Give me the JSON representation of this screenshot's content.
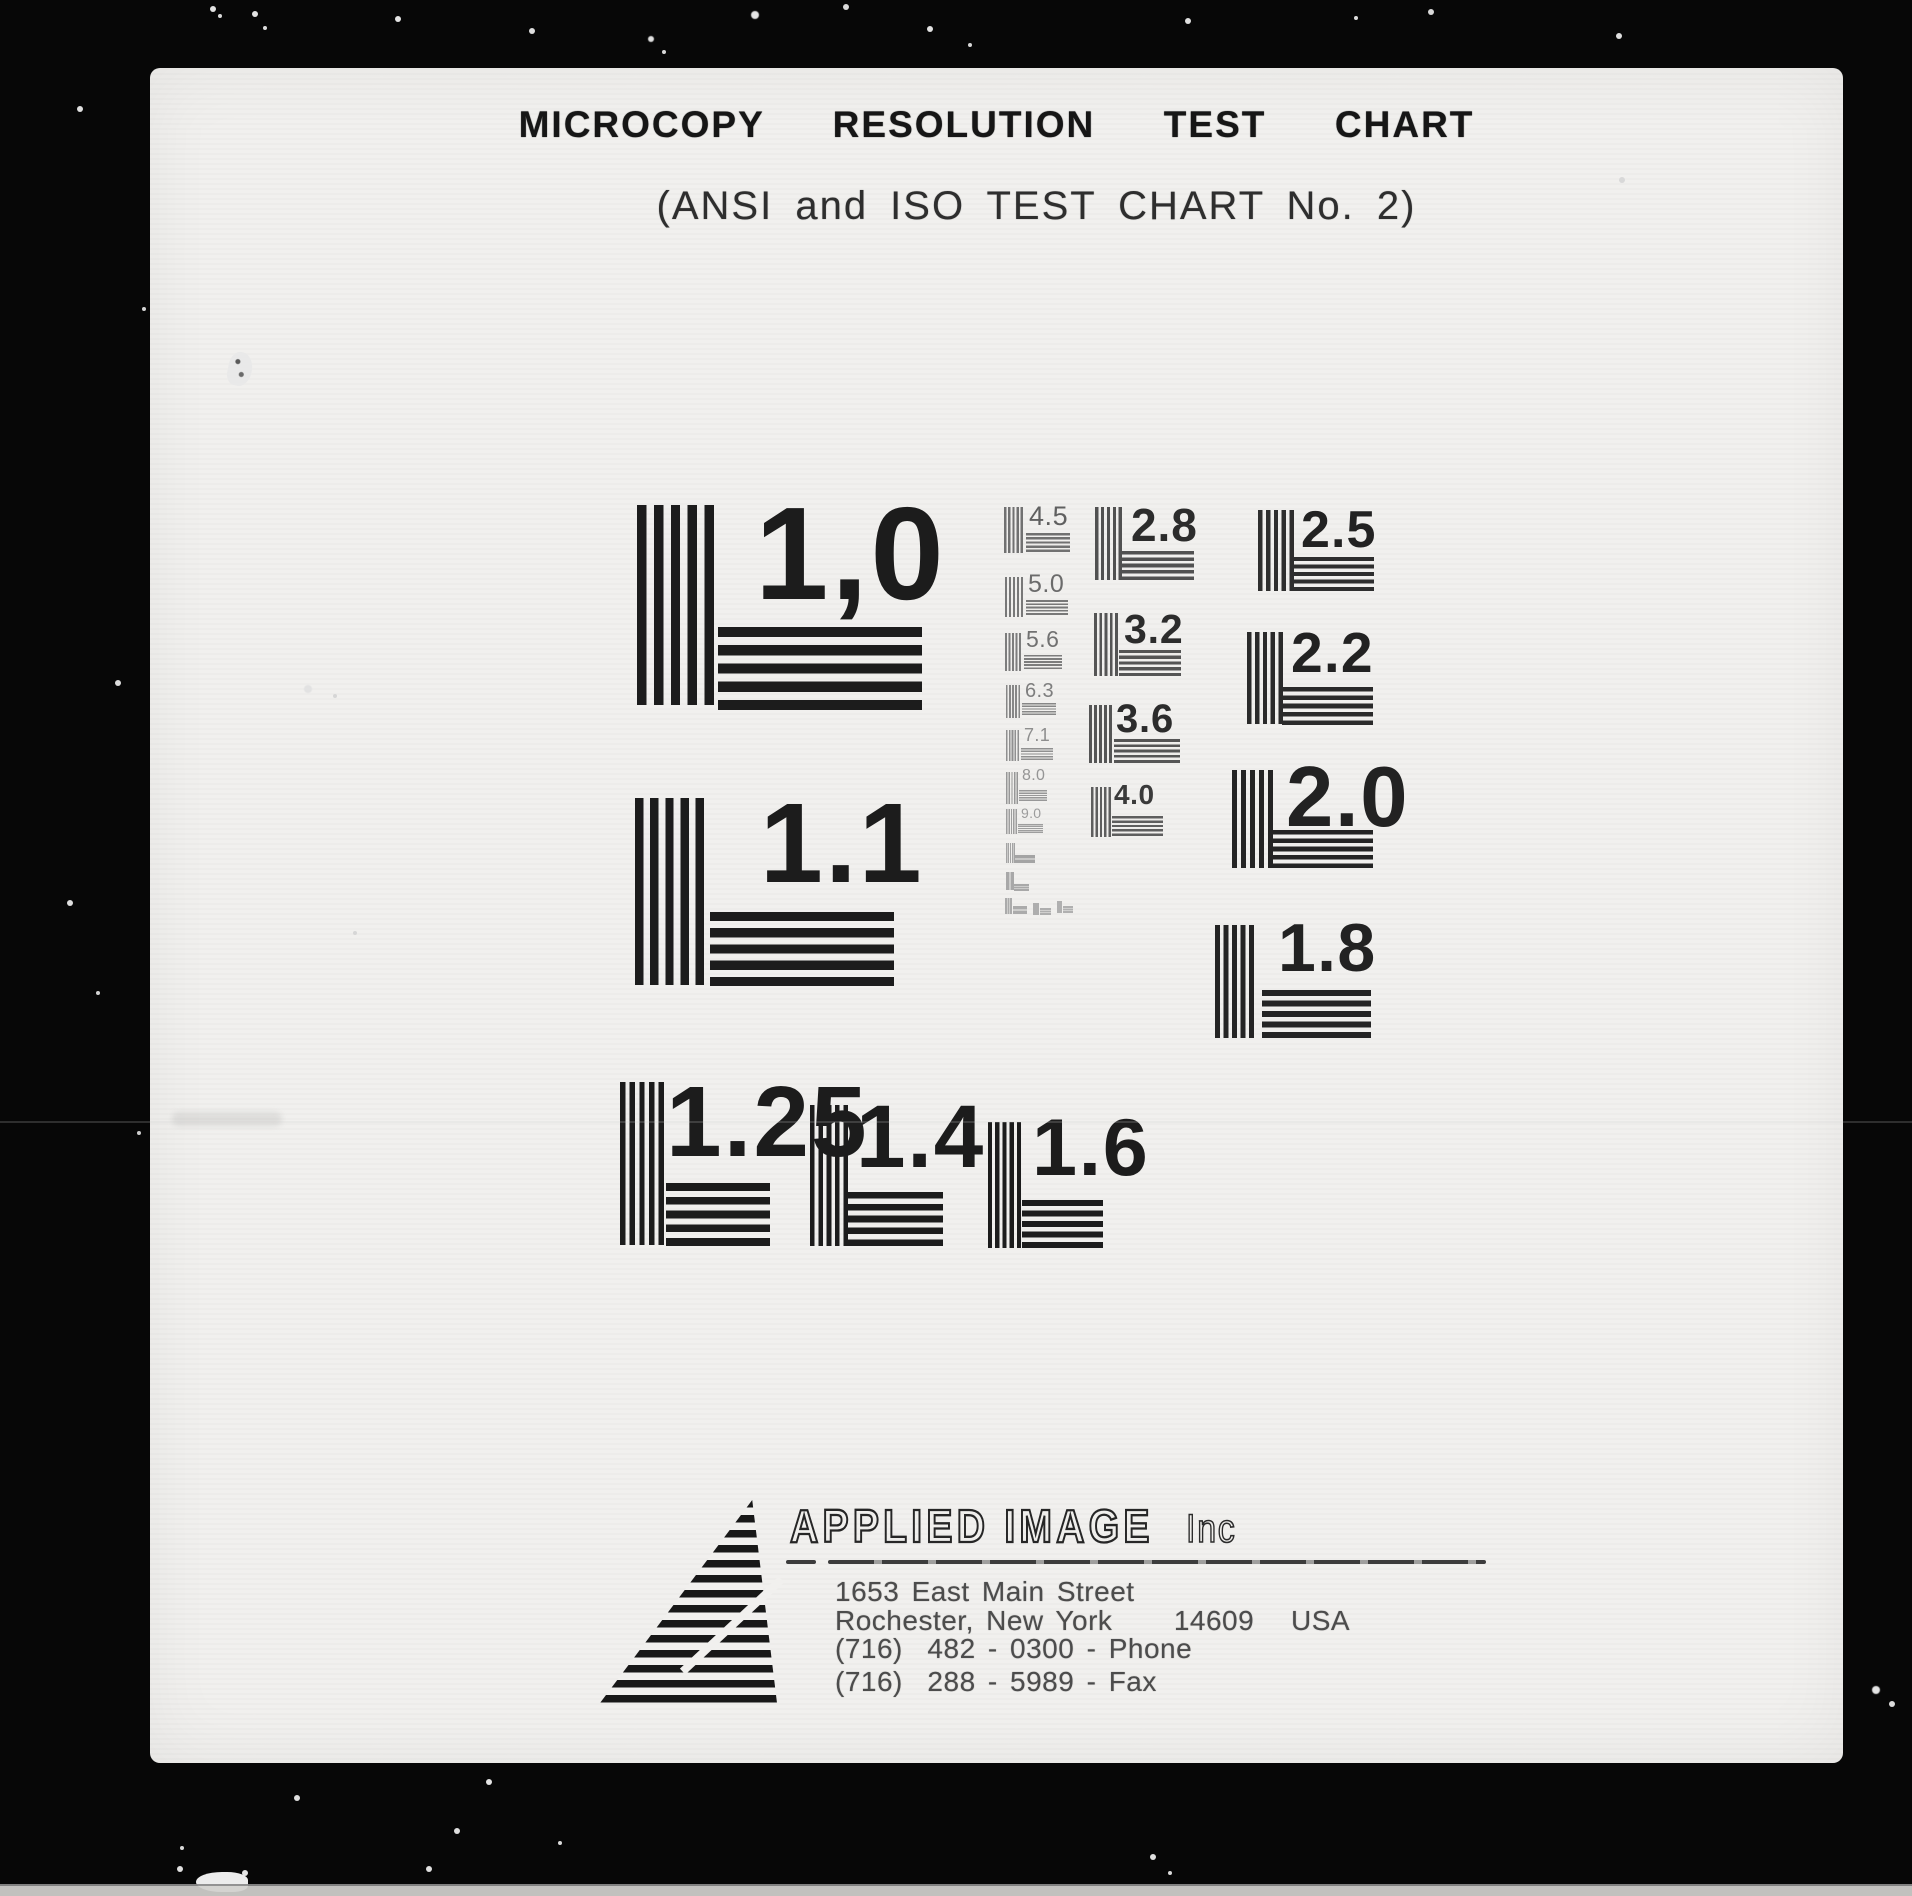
{
  "document": {
    "title": "MICROCOPY  RESOLUTION  TEST  CHART",
    "subtitle": "(ANSI and ISO TEST CHART No. 2)"
  },
  "patterns": [
    {
      "label": "1,0",
      "ink": "#1c1c1c",
      "bar": "#1c1c1c",
      "v": [
        637,
        505,
        77,
        200
      ],
      "h": [
        718,
        627,
        204,
        83
      ],
      "n": [
        755,
        488,
        132,
        700
      ]
    },
    {
      "label": "1.1",
      "ink": "#1c1c1c",
      "bar": "#1c1c1c",
      "v": [
        635,
        798,
        69,
        187
      ],
      "h": [
        710,
        912,
        184,
        74
      ],
      "n": [
        760,
        787,
        113,
        700
      ]
    },
    {
      "label": "1.25",
      "ink": "#1c1c1c",
      "bar": "#1c1c1c",
      "v": [
        620,
        1082,
        44,
        163
      ],
      "h": [
        666,
        1183,
        104,
        63
      ],
      "n": [
        666,
        1072,
        100,
        700
      ]
    },
    {
      "label": "1.4",
      "ink": "#1c1c1c",
      "bar": "#1c1c1c",
      "v": [
        810,
        1105,
        38,
        141
      ],
      "h": [
        848,
        1192,
        95,
        54
      ],
      "n": [
        856,
        1092,
        89,
        700
      ]
    },
    {
      "label": "1.6",
      "ink": "#1c1c1c",
      "bar": "#1c1c1c",
      "v": [
        988,
        1122,
        33,
        126
      ],
      "h": [
        1022,
        1200,
        81,
        48
      ],
      "n": [
        1032,
        1108,
        81,
        700
      ]
    },
    {
      "label": "1.8",
      "ink": "#222222",
      "bar": "#242424",
      "v": [
        1215,
        925,
        39,
        113
      ],
      "h": [
        1262,
        990,
        109,
        48
      ],
      "n": [
        1278,
        914,
        68,
        700
      ]
    },
    {
      "label": "2.0",
      "ink": "#222222",
      "bar": "#242424",
      "v": [
        1232,
        770,
        41,
        98
      ],
      "h": [
        1273,
        830,
        100,
        38
      ],
      "n": [
        1286,
        755,
        85,
        700
      ]
    },
    {
      "label": "2.2",
      "ink": "#222222",
      "bar": "#2a2a2a",
      "v": [
        1247,
        632,
        36,
        92
      ],
      "h": [
        1282,
        687,
        91,
        38
      ],
      "n": [
        1291,
        625,
        57,
        700
      ]
    },
    {
      "label": "2.5",
      "ink": "#222222",
      "bar": "#2e2e2e",
      "v": [
        1258,
        510,
        36,
        81
      ],
      "h": [
        1294,
        557,
        80,
        34
      ],
      "n": [
        1301,
        504,
        52,
        700
      ]
    },
    {
      "label": "2.8",
      "ink": "#2c2c2c",
      "bar": "#515151",
      "v": [
        1095,
        507,
        27,
        73
      ],
      "h": [
        1122,
        551,
        72,
        29
      ],
      "n": [
        1131,
        502,
        46,
        700
      ]
    },
    {
      "label": "3.2",
      "ink": "#2c2c2c",
      "bar": "#555555",
      "v": [
        1094,
        613,
        24,
        63
      ],
      "h": [
        1119,
        650,
        62,
        26
      ],
      "n": [
        1124,
        609,
        41,
        700
      ]
    },
    {
      "label": "3.6",
      "ink": "#2c2c2c",
      "bar": "#555555",
      "v": [
        1089,
        705,
        23,
        58
      ],
      "h": [
        1114,
        739,
        66,
        24
      ],
      "n": [
        1116,
        699,
        40,
        700
      ]
    },
    {
      "label": "4.0",
      "ink": "#3a3a3a",
      "bar": "#5e5e5e",
      "v": [
        1091,
        787,
        20,
        50
      ],
      "h": [
        1112,
        816,
        51,
        20
      ],
      "n": [
        1114,
        781,
        28,
        700
      ]
    },
    {
      "label": "4.5",
      "ink": "#606060",
      "bar": "#717171",
      "v": [
        1004,
        507,
        19,
        46
      ],
      "h": [
        1026,
        533,
        44,
        19
      ],
      "n": [
        1029,
        503,
        27,
        400
      ]
    },
    {
      "label": "5.0",
      "ink": "#6b6b6b",
      "bar": "#787878",
      "v": [
        1005,
        577,
        18,
        40
      ],
      "h": [
        1026,
        600,
        42,
        15
      ],
      "n": [
        1028,
        572,
        25,
        400
      ]
    },
    {
      "label": "5.6",
      "ink": "#717171",
      "bar": "#7d7d7d",
      "v": [
        1005,
        633,
        16,
        38
      ],
      "h": [
        1024,
        655,
        38,
        14
      ],
      "n": [
        1026,
        628,
        23,
        400
      ]
    },
    {
      "label": "6.3",
      "ink": "#7e7e7e",
      "bar": "#878787",
      "v": [
        1006,
        685,
        14,
        33
      ],
      "h": [
        1022,
        703,
        34,
        12
      ],
      "n": [
        1025,
        681,
        20,
        400
      ]
    },
    {
      "label": "7.1",
      "ink": "#8e8e8e",
      "bar": "#909090",
      "v": [
        1006,
        730,
        13,
        31
      ],
      "h": [
        1021,
        748,
        32,
        12
      ],
      "n": [
        1024,
        726,
        18,
        400
      ]
    },
    {
      "label": "8.0",
      "ink": "#959595",
      "bar": "#979797",
      "v": [
        1006,
        772,
        12,
        32
      ],
      "h": [
        1019,
        790,
        28,
        11
      ],
      "n": [
        1022,
        768,
        16,
        400
      ]
    },
    {
      "label": "9.0",
      "ink": "#9c9c9c",
      "bar": "#9e9e9e",
      "v": [
        1006,
        809,
        11,
        25
      ],
      "h": [
        1018,
        824,
        25,
        9
      ],
      "n": [
        1021,
        806,
        14,
        400
      ]
    },
    {
      "label": "",
      "ink": "#a4a4a4",
      "bar": "#a4a4a4",
      "v": [
        1006,
        843,
        9,
        20
      ],
      "h": [
        1015,
        855,
        20,
        8
      ]
    },
    {
      "label": "",
      "ink": "#a8a8a8",
      "bar": "#a8a8a8",
      "v": [
        1006,
        872,
        8,
        18
      ],
      "h": [
        1014,
        884,
        15,
        7
      ]
    },
    {
      "label": "",
      "ink": "#ababab",
      "bar": "#ababab",
      "v": [
        1005,
        898,
        7,
        16
      ],
      "h": [
        1013,
        906,
        14,
        8
      ]
    },
    {
      "label": "",
      "ink": "#aeaeae",
      "bar": "#aeaeae",
      "v": [
        1033,
        903,
        6,
        12
      ],
      "h": [
        1040,
        908,
        11,
        7
      ]
    },
    {
      "label": "",
      "ink": "#b0b0b0",
      "bar": "#b0b0b0",
      "v": [
        1057,
        901,
        5,
        12
      ],
      "h": [
        1063,
        906,
        10,
        7
      ]
    }
  ],
  "footer": {
    "company": "APPLIED IMAGE",
    "company_suffix": "Inc",
    "address_line_1": "1653 East Main Street",
    "address_line_2": "Rochester, New York     14609   USA",
    "phone_line": "(716)  482 - 0300 - Phone",
    "fax_line": "(716)  288 - 5989 - Fax"
  },
  "colors": {
    "paper": "#f1f0ee",
    "background": "#070707",
    "ink_primary": "#1c1c1c"
  }
}
